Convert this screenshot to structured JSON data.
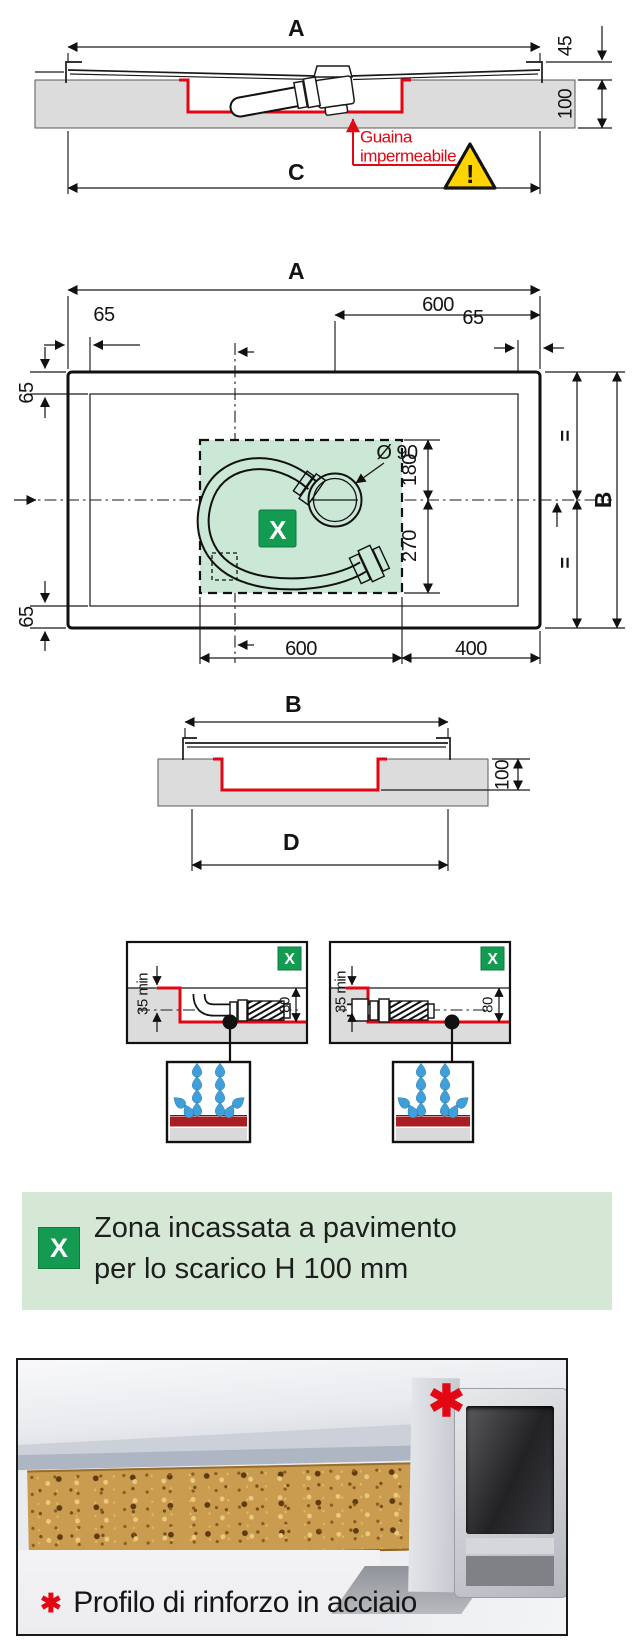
{
  "colors": {
    "red": "#e30613",
    "green": "#149b52",
    "zone_green": "#cbe7d6",
    "banner_green": "#d5e8d6",
    "floor_gray": "#dcdcdc",
    "drop_blue": "#3f9fd8",
    "warning_yellow": "#ffd400",
    "band_red": "#a81e22"
  },
  "section_a": {
    "dim_a": "A",
    "dim_45": "45",
    "dim_100": "100",
    "dim_c": "C",
    "membrane_line1": "Guaina",
    "membrane_line2": "impermeabile",
    "warning_mark": "!"
  },
  "plan": {
    "dim_a": "A",
    "dim_600_top": "600",
    "dim_65_top_left": "65",
    "dim_65_top_right": "65",
    "dim_65_left_upper": "65",
    "dim_65_left_lower": "65",
    "dim_b": "B",
    "equal_upper": "=",
    "equal_lower": "=",
    "drain_diameter": "Ø 90",
    "dim_180": "180",
    "dim_270": "270",
    "dim_600_bottom": "600",
    "dim_400": "400",
    "zone_marker": "X"
  },
  "section_b": {
    "dim_b": "B",
    "dim_100": "100",
    "dim_d": "D"
  },
  "details": {
    "left": {
      "dim_35": "35 min",
      "dim_80": "80",
      "marker": "X"
    },
    "right": {
      "dim_35": "35 min",
      "dim_80": "80",
      "marker": "X"
    }
  },
  "legend": {
    "marker": "X",
    "line1": "Zona incassata a pavimento",
    "line2": "per lo scarico H 100 mm"
  },
  "photo": {
    "marker": "✱",
    "caption_marker": "✱",
    "caption": "Profilo di rinforzo in acciaio"
  }
}
